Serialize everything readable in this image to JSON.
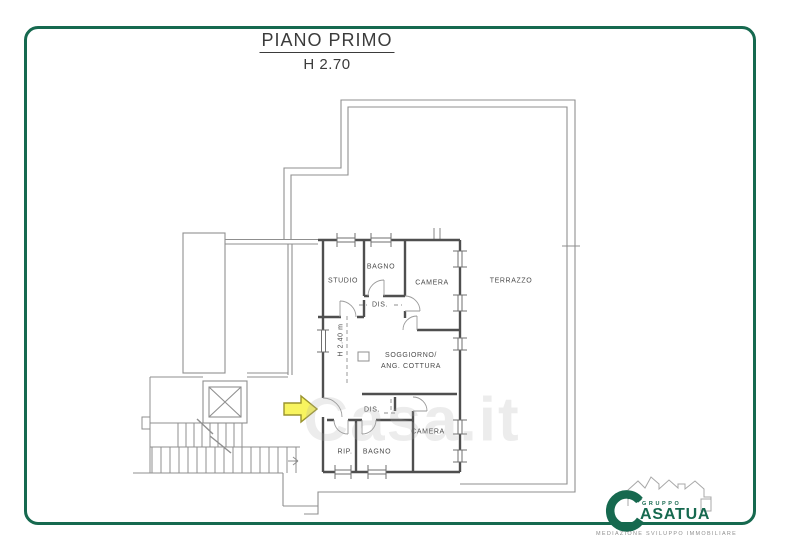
{
  "header": {
    "title": "PIANO PRIMO",
    "subtitle": "H 2.70"
  },
  "plan_labels": {
    "studio": "STUDIO",
    "bagno_top": "BAGNO",
    "camera_top": "CAMERA",
    "dis_top": "DIS.",
    "terrazzo": "TERRAZZO",
    "soggiorno_line1": "SOGGIORNO/",
    "soggiorno_line2": "ANG. COTTURA",
    "interior_height": "H 2.40 m",
    "dis_bottom": "DIS.",
    "rip": "RIP.",
    "bagno_bottom": "BAGNO",
    "camera_bottom": "CAMERA"
  },
  "watermark": "Casa.it",
  "logo": {
    "group_word": "GRUPPO",
    "brand_word": "ASATUA",
    "tagline": "MEDIAZIONE SVILUPPO IMMOBILIARE"
  },
  "colors": {
    "border_green": "#16694f",
    "logo_green": "#16694f",
    "arrow_yellow": "#f8f45f",
    "arrow_outline": "#9a942e",
    "wall_gray": "#4f4f4f",
    "thin_line_gray": "#8f8f8f"
  }
}
